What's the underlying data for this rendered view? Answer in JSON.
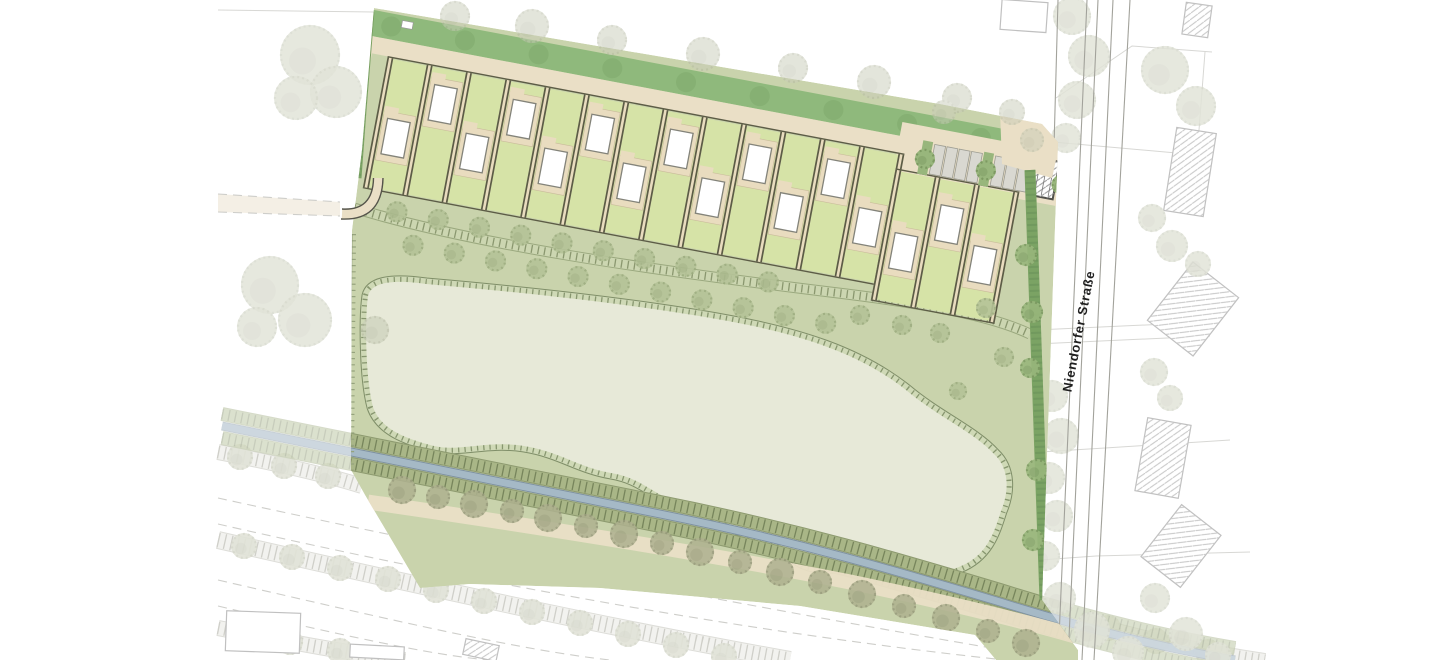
{
  "plan": {
    "street": {
      "label": "Niendorfer Straße"
    },
    "counts": {
      "house_plots_total": 16,
      "row_plots": 13,
      "offset_plots": 3,
      "houses": 16,
      "parking_stalls": 7,
      "parking_trees": 3,
      "orchard_trees": 28,
      "existing_buildings_hatched": 5
    },
    "colors": {
      "band_green": "#8fb97c",
      "band_shade": "#7da76a",
      "plot_green": "#d6e3a7",
      "patio": "#e9dcbf",
      "path_beige": "#eadfc6",
      "ctx_beige": "#ece3d0",
      "separator": "#5c5c46",
      "house": "#ffffff",
      "house_stroke": "#83837a",
      "meadow": "#c9d3ac",
      "strip_band": "#ccd6b1",
      "strip_tick": "#8a976f",
      "pond": "#e7e9d8",
      "pond_edge": "#7f8e68",
      "pond_band": "#cfd9b6",
      "pond_tick": "#87966f",
      "hedge": "#7ba364",
      "boundary_tick": "#95a37d",
      "stream": "#a5b9c6",
      "stream_edge": "#7e91a0",
      "embank": "#a9b687",
      "embank_tick": "#77855c",
      "orchard": "#b5c398",
      "orchard_shade": "#9dad80",
      "corridor_tree": "#aeb18f",
      "ctx_tree": "#c9cdb8",
      "stall": "#d9d8d1",
      "stall_stroke": "#9c9c92",
      "island": "#98b67c",
      "shed_stroke": "#50504a",
      "hatch": "#9a9a9a",
      "bldg_stroke": "#8e8e8e",
      "road_line": "#a2a29b",
      "parcel": "#b8b8b2",
      "dash_line": "#a7a7a0",
      "curb": "#55544a",
      "label": "#1f1f1f"
    }
  }
}
